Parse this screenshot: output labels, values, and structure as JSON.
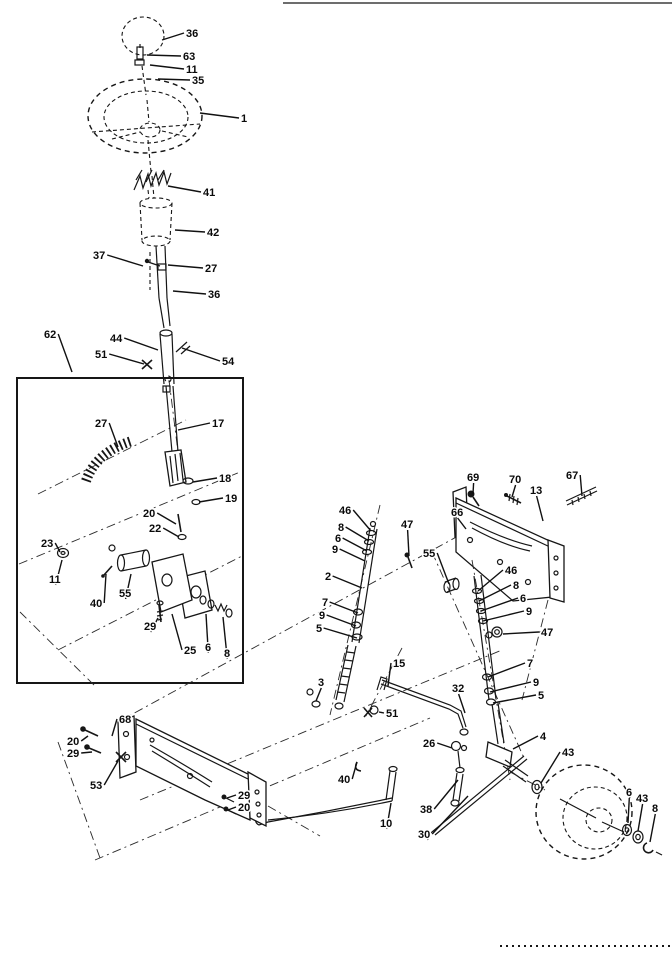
{
  "figure": {
    "colors": {
      "ink": "#161616",
      "paper": "#ffffff"
    },
    "callouts": [
      {
        "t": "36",
        "x": 186,
        "y": 37,
        "x2": 162,
        "y2": 40
      },
      {
        "t": "63",
        "x": 183,
        "y": 60,
        "x2": 147,
        "y2": 55
      },
      {
        "t": "11",
        "x": 186,
        "y": 73,
        "x2": 150,
        "y2": 65
      },
      {
        "t": "35",
        "x": 192,
        "y": 84,
        "x2": 158,
        "y2": 79
      },
      {
        "t": "1",
        "x": 241,
        "y": 122,
        "x2": 200,
        "y2": 113
      },
      {
        "t": "41",
        "x": 203,
        "y": 196,
        "x2": 168,
        "y2": 186
      },
      {
        "t": "42",
        "x": 207,
        "y": 236,
        "x2": 175,
        "y2": 230
      },
      {
        "t": "37",
        "x": 93,
        "y": 259,
        "x2": 143,
        "y2": 266
      },
      {
        "t": "27",
        "x": 205,
        "y": 272,
        "x2": 168,
        "y2": 265
      },
      {
        "t": "36",
        "x": 208,
        "y": 298,
        "x2": 173,
        "y2": 291
      },
      {
        "t": "62",
        "x": 44,
        "y": 338,
        "x2": 72,
        "y2": 372
      },
      {
        "t": "44",
        "x": 110,
        "y": 342,
        "x2": 158,
        "y2": 350
      },
      {
        "t": "51",
        "x": 95,
        "y": 358,
        "x2": 144,
        "y2": 364
      },
      {
        "t": "54",
        "x": 222,
        "y": 365,
        "x2": 182,
        "y2": 348
      },
      {
        "t": "17",
        "x": 212,
        "y": 427,
        "x2": 178,
        "y2": 430
      },
      {
        "t": "27",
        "x": 95,
        "y": 427,
        "x2": 118,
        "y2": 447
      },
      {
        "t": "18",
        "x": 219,
        "y": 482,
        "x2": 193,
        "y2": 482
      },
      {
        "t": "19",
        "x": 225,
        "y": 502,
        "x2": 199,
        "y2": 502
      },
      {
        "t": "20",
        "x": 143,
        "y": 517,
        "x2": 176,
        "y2": 524
      },
      {
        "t": "22",
        "x": 149,
        "y": 532,
        "x2": 179,
        "y2": 537
      },
      {
        "t": "23",
        "x": 41,
        "y": 547,
        "x2": 60,
        "y2": 552
      },
      {
        "t": "11",
        "x": 49,
        "y": 583,
        "x2": 62,
        "y2": 560
      },
      {
        "t": "40",
        "x": 90,
        "y": 607,
        "x2": 106,
        "y2": 574
      },
      {
        "t": "55",
        "x": 119,
        "y": 597,
        "x2": 131,
        "y2": 574
      },
      {
        "t": "29",
        "x": 144,
        "y": 630,
        "x2": 158,
        "y2": 618
      },
      {
        "t": "25",
        "x": 184,
        "y": 654,
        "x2": 172,
        "y2": 614
      },
      {
        "t": "6",
        "x": 205,
        "y": 651,
        "x2": 206,
        "y2": 614
      },
      {
        "t": "8",
        "x": 224,
        "y": 657,
        "x2": 223,
        "y2": 617
      },
      {
        "t": "69",
        "x": 467,
        "y": 481,
        "x2": 473,
        "y2": 494
      },
      {
        "t": "70",
        "x": 509,
        "y": 483,
        "x2": 512,
        "y2": 497
      },
      {
        "t": "13",
        "x": 530,
        "y": 494,
        "x2": 543,
        "y2": 521
      },
      {
        "t": "67",
        "x": 566,
        "y": 479,
        "x2": 582,
        "y2": 496
      },
      {
        "t": "66",
        "x": 451,
        "y": 516,
        "x2": 466,
        "y2": 529
      },
      {
        "t": "46",
        "x": 339,
        "y": 514,
        "x2": 371,
        "y2": 531
      },
      {
        "t": "8",
        "x": 338,
        "y": 531,
        "x2": 369,
        "y2": 541
      },
      {
        "t": "6",
        "x": 335,
        "y": 542,
        "x2": 367,
        "y2": 551
      },
      {
        "t": "9",
        "x": 332,
        "y": 553,
        "x2": 365,
        "y2": 561
      },
      {
        "t": "2",
        "x": 325,
        "y": 580,
        "x2": 362,
        "y2": 588
      },
      {
        "t": "7",
        "x": 322,
        "y": 606,
        "x2": 358,
        "y2": 613
      },
      {
        "t": "9",
        "x": 319,
        "y": 619,
        "x2": 356,
        "y2": 626
      },
      {
        "t": "5",
        "x": 316,
        "y": 632,
        "x2": 357,
        "y2": 638
      },
      {
        "t": "47",
        "x": 401,
        "y": 528,
        "x2": 409,
        "y2": 556
      },
      {
        "t": "55",
        "x": 423,
        "y": 557,
        "x2": 449,
        "y2": 584
      },
      {
        "t": "46",
        "x": 505,
        "y": 574,
        "x2": 478,
        "y2": 591
      },
      {
        "t": "8",
        "x": 513,
        "y": 589,
        "x2": 479,
        "y2": 601
      },
      {
        "t": "6",
        "x": 520,
        "y": 602,
        "x2": 481,
        "y2": 611
      },
      {
        "t": "9",
        "x": 526,
        "y": 615,
        "x2": 483,
        "y2": 621
      },
      {
        "t": "47",
        "x": 541,
        "y": 636,
        "x2": 503,
        "y2": 634
      },
      {
        "t": "7",
        "x": 527,
        "y": 667,
        "x2": 488,
        "y2": 677
      },
      {
        "t": "9",
        "x": 533,
        "y": 686,
        "x2": 490,
        "y2": 692
      },
      {
        "t": "5",
        "x": 538,
        "y": 699,
        "x2": 493,
        "y2": 703
      },
      {
        "t": "4",
        "x": 540,
        "y": 740,
        "x2": 513,
        "y2": 749
      },
      {
        "t": "15",
        "x": 393,
        "y": 667,
        "x2": 388,
        "y2": 686
      },
      {
        "t": "3",
        "x": 318,
        "y": 686,
        "x2": 316,
        "y2": 701
      },
      {
        "t": "32",
        "x": 452,
        "y": 692,
        "x2": 465,
        "y2": 713
      },
      {
        "t": "51",
        "x": 386,
        "y": 717,
        "x2": 379,
        "y2": 712
      },
      {
        "t": "26",
        "x": 423,
        "y": 747,
        "x2": 452,
        "y2": 748
      },
      {
        "t": "40",
        "x": 338,
        "y": 783,
        "x2": 357,
        "y2": 762
      },
      {
        "t": "10",
        "x": 380,
        "y": 827,
        "x2": 391,
        "y2": 803
      },
      {
        "t": "38",
        "x": 420,
        "y": 813,
        "x2": 458,
        "y2": 780
      },
      {
        "t": "30",
        "x": 418,
        "y": 838,
        "x2": 468,
        "y2": 796
      },
      {
        "t": "68",
        "x": 119,
        "y": 723,
        "x2": 112,
        "y2": 736
      },
      {
        "t": "20",
        "x": 67,
        "y": 745,
        "x2": 88,
        "y2": 736
      },
      {
        "t": "29",
        "x": 67,
        "y": 757,
        "x2": 92,
        "y2": 752
      },
      {
        "t": "53",
        "x": 90,
        "y": 789,
        "x2": 118,
        "y2": 761
      },
      {
        "t": "29",
        "x": 238,
        "y": 799,
        "x2": 227,
        "y2": 798
      },
      {
        "t": "20",
        "x": 238,
        "y": 811,
        "x2": 228,
        "y2": 810
      },
      {
        "t": "43",
        "x": 562,
        "y": 756,
        "x2": 541,
        "y2": 783
      },
      {
        "t": "6",
        "x": 626,
        "y": 796,
        "x2": 628,
        "y2": 823
      },
      {
        "t": "43",
        "x": 636,
        "y": 802,
        "x2": 638,
        "y2": 831
      },
      {
        "t": "8",
        "x": 652,
        "y": 812,
        "x2": 650,
        "y2": 842
      }
    ]
  }
}
